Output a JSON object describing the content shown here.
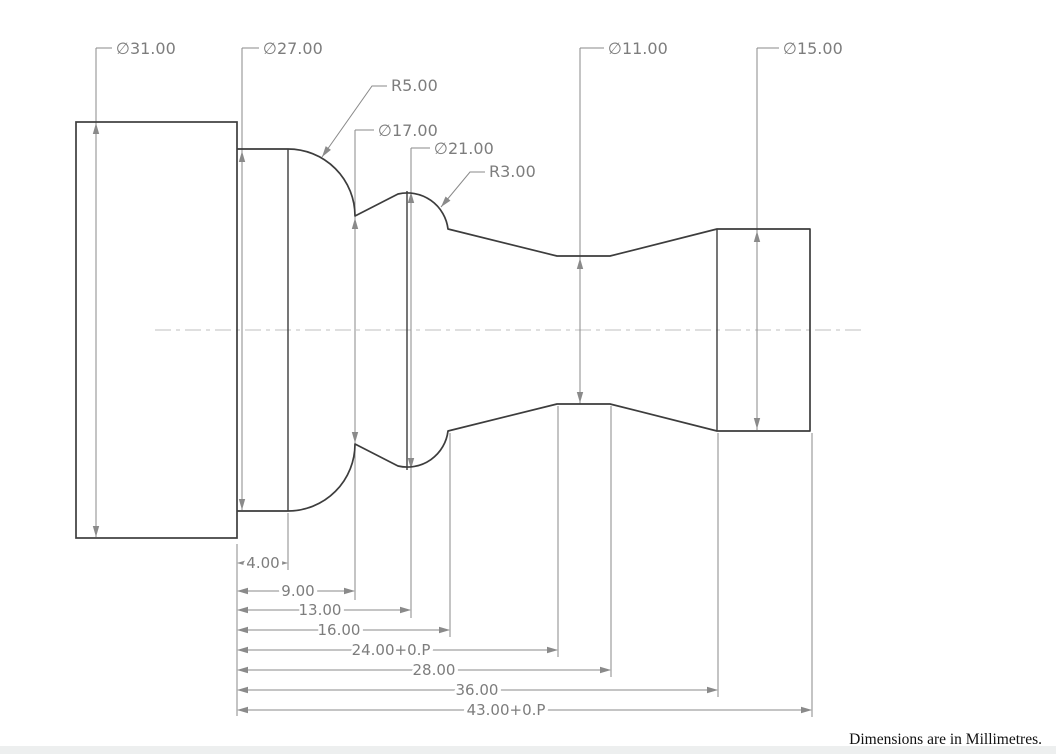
{
  "note": "Dimensions are in Millimetres.",
  "colors": {
    "background": "#ffffff",
    "part_line": "#3d3d3d",
    "dim_line": "#8a8a8a",
    "dim_text": "#7d7d7d",
    "centerline": "#cccccc",
    "note_text": "#111111",
    "bottom_strip": "#edefef"
  },
  "diagram": {
    "type": "engineering_drawing",
    "view": "side profile of a turned (lathe) shaft",
    "units": "mm",
    "diameters_mm": [
      31,
      27,
      17,
      21,
      11,
      15
    ],
    "radii_mm": [
      5,
      3
    ],
    "lengths_mm": [
      "4.00",
      "9.00",
      "13.00",
      "16.00",
      "24.00+0.P",
      "28.00",
      "36.00",
      "43.00+0.P"
    ],
    "part": {
      "rect": [
        76,
        122,
        161,
        416
      ],
      "profile": "M 237 149 L 288 149 A 67 67 0 0 1 355 216 L 398 194 A 41 41 0 0 1 448 229 L 557 256 L 610 256 L 717 229 L 810 229 L 810 431 L 717 431 L 610 404 L 557 404 L 448 431 A 41 41 0 0 1 398 466 L 355 444 A 67 67 0 0 1 288 511 L 237 511",
      "edges": [
        [
          288,
          149,
          288,
          511
        ],
        [
          407,
          191,
          407,
          470
        ],
        [
          717,
          229,
          717,
          431
        ]
      ],
      "centerline": [
        155,
        330,
        866,
        330
      ]
    },
    "dia_dims": [
      {
        "label": "∅31.00",
        "x": 96,
        "y1": 48,
        "y2": 537,
        "up": 123,
        "down": 537,
        "jog": 112,
        "tx": 116,
        "ty": 54
      },
      {
        "label": "∅27.00",
        "x": 242,
        "y1": 48,
        "y2": 510,
        "up": 151,
        "down": 510,
        "jog": 259,
        "tx": 263,
        "ty": 54
      },
      {
        "label": "∅17.00",
        "x": 355,
        "y1": 130,
        "y2": 600,
        "up": 218,
        "down": 443,
        "jog": 374,
        "tx": 378,
        "ty": 136
      },
      {
        "label": "∅21.00",
        "x": 411,
        "y1": 148,
        "y2": 618,
        "up": 192,
        "down": 469,
        "jog": 430,
        "tx": 434,
        "ty": 154
      },
      {
        "label": "∅11.00",
        "x": 580,
        "y1": 48,
        "y2": 404,
        "up": 258,
        "down": 403,
        "jog": 604,
        "tx": 608,
        "ty": 54
      },
      {
        "label": "∅15.00",
        "x": 757,
        "y1": 48,
        "y2": 430,
        "up": 231,
        "down": 429,
        "jog": 779,
        "tx": 783,
        "ty": 54
      }
    ],
    "radius_dims": [
      {
        "label": "R5.00",
        "pts": [
          [
            387,
            86
          ],
          [
            372,
            86
          ],
          [
            322,
            157
          ]
        ],
        "tx": 391,
        "ty": 91
      },
      {
        "label": "R3.00",
        "pts": [
          [
            485,
            172
          ],
          [
            470,
            172
          ],
          [
            441,
            207
          ]
        ],
        "tx": 489,
        "ty": 177
      }
    ],
    "chain_dims": [
      {
        "label": "4.00",
        "y": 563,
        "x1": 238,
        "x2": 288,
        "tc": 263
      },
      {
        "label": "9.00",
        "y": 591,
        "x1": 238,
        "x2": 355,
        "tc": 298
      },
      {
        "label": "13.00",
        "y": 610,
        "x1": 238,
        "x2": 411,
        "tc": 320
      },
      {
        "label": "16.00",
        "y": 630,
        "x1": 238,
        "x2": 450,
        "tc": 339
      },
      {
        "label": "24.00+0.P",
        "y": 650,
        "x1": 238,
        "x2": 558,
        "tc": 391
      },
      {
        "label": "28.00",
        "y": 670,
        "x1": 238,
        "x2": 611,
        "tc": 434
      },
      {
        "label": "36.00",
        "y": 690,
        "x1": 238,
        "x2": 718,
        "tc": 477
      },
      {
        "label": "43.00+0.P",
        "y": 710,
        "x1": 238,
        "x2": 812,
        "tc": 506
      }
    ],
    "ext_lines": [
      [
        237,
        544,
        237,
        716
      ],
      [
        288,
        513,
        288,
        570
      ],
      [
        450,
        433,
        450,
        637
      ],
      [
        558,
        406,
        558,
        657
      ],
      [
        611,
        406,
        611,
        677
      ],
      [
        718,
        433,
        718,
        697
      ],
      [
        812,
        433,
        812,
        717
      ]
    ]
  }
}
